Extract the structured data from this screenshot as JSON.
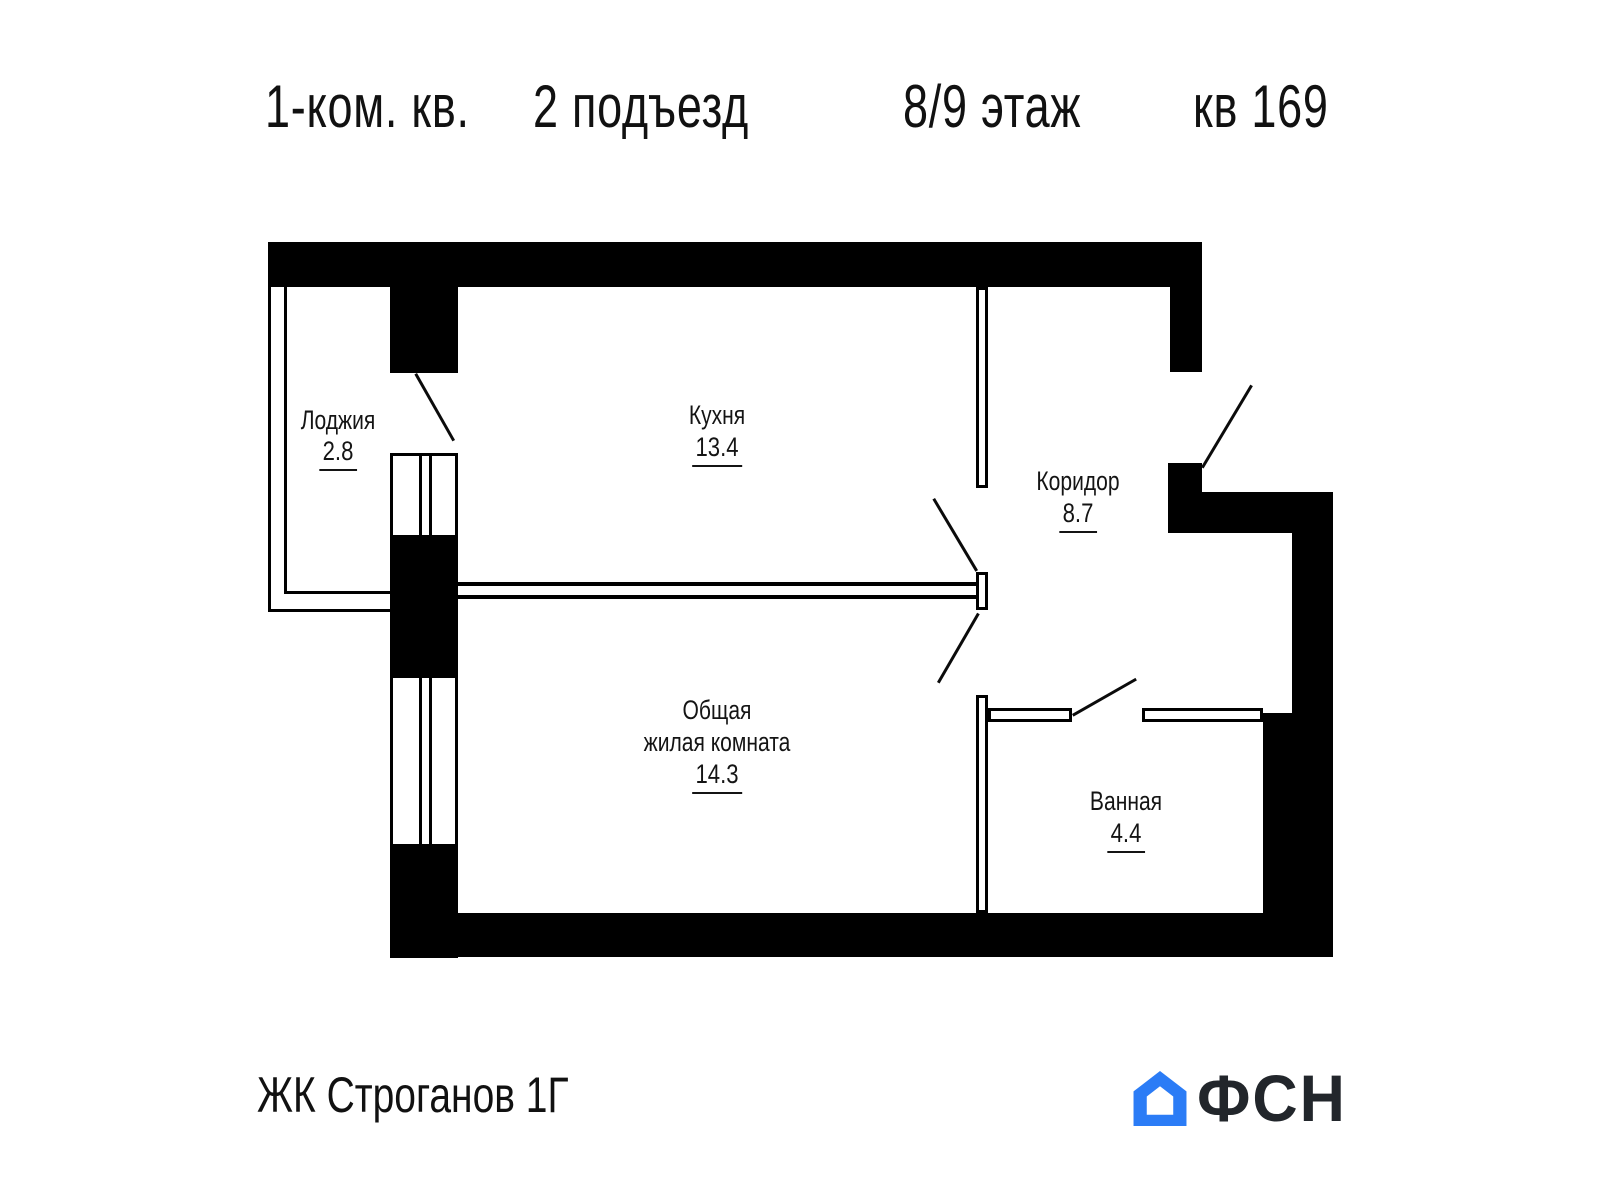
{
  "header": {
    "unit": "1-ком. кв.",
    "entrance": "2 подъезд",
    "floor": "8/9 этаж",
    "number": "кв 169"
  },
  "rooms": {
    "loggia": {
      "label": "Лоджия",
      "area": "2.8"
    },
    "kitchen": {
      "label": "Кухня",
      "area": "13.4"
    },
    "corridor": {
      "label": "Коридор",
      "area": "8.7"
    },
    "living": {
      "label_line1": "Общая",
      "label_line2": "жилая комната",
      "area": "14.3"
    },
    "bathroom": {
      "label": "Ванная",
      "area": "4.4"
    }
  },
  "footer": {
    "complex": "ЖК Строганов 1Г",
    "logo_text": "ФСН"
  },
  "colors": {
    "wall": "#000000",
    "text": "#141414",
    "logo_blue": "#2b7cf6",
    "logo_dark": "#22262b",
    "background": "#ffffff"
  }
}
